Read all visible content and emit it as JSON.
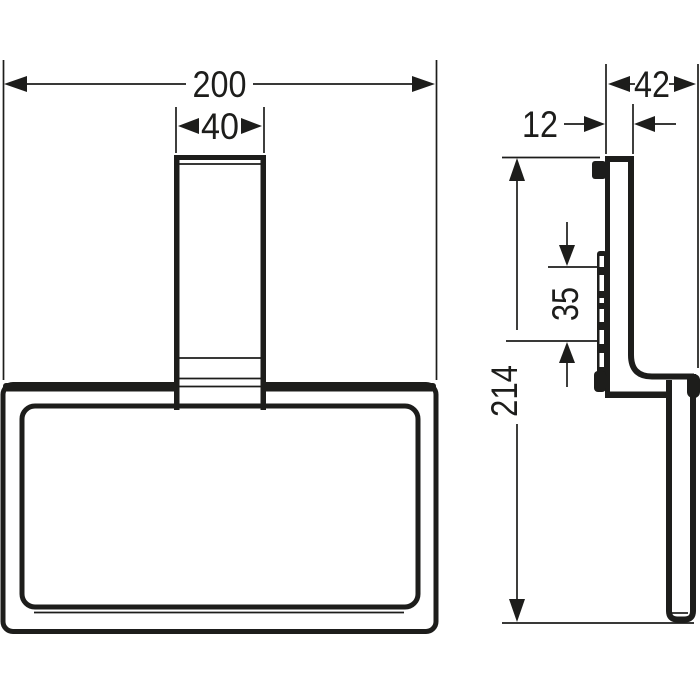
{
  "drawing": {
    "type": "technical-dimension-drawing",
    "subject": "wall-mounted towel ring",
    "background_color": "#ffffff",
    "line_color": "#1d1d1b",
    "views": {
      "front": {
        "name": "front-view",
        "dimensions": [
          {
            "id": "overall_width",
            "value": "200",
            "orientation": "horizontal"
          },
          {
            "id": "post_width",
            "value": "40",
            "orientation": "horizontal"
          }
        ]
      },
      "side": {
        "name": "side-view",
        "dimensions": [
          {
            "id": "overall_depth",
            "value": "42",
            "orientation": "horizontal"
          },
          {
            "id": "plate_depth",
            "value": "12",
            "orientation": "horizontal"
          },
          {
            "id": "mounting_span",
            "value": "35",
            "orientation": "vertical"
          },
          {
            "id": "overall_height",
            "value": "214",
            "orientation": "vertical"
          }
        ]
      }
    },
    "dims": {
      "overall_width": "200",
      "post_width": "40",
      "overall_depth": "42",
      "plate_depth": "12",
      "mounting_span": "35",
      "overall_height": "214"
    }
  }
}
